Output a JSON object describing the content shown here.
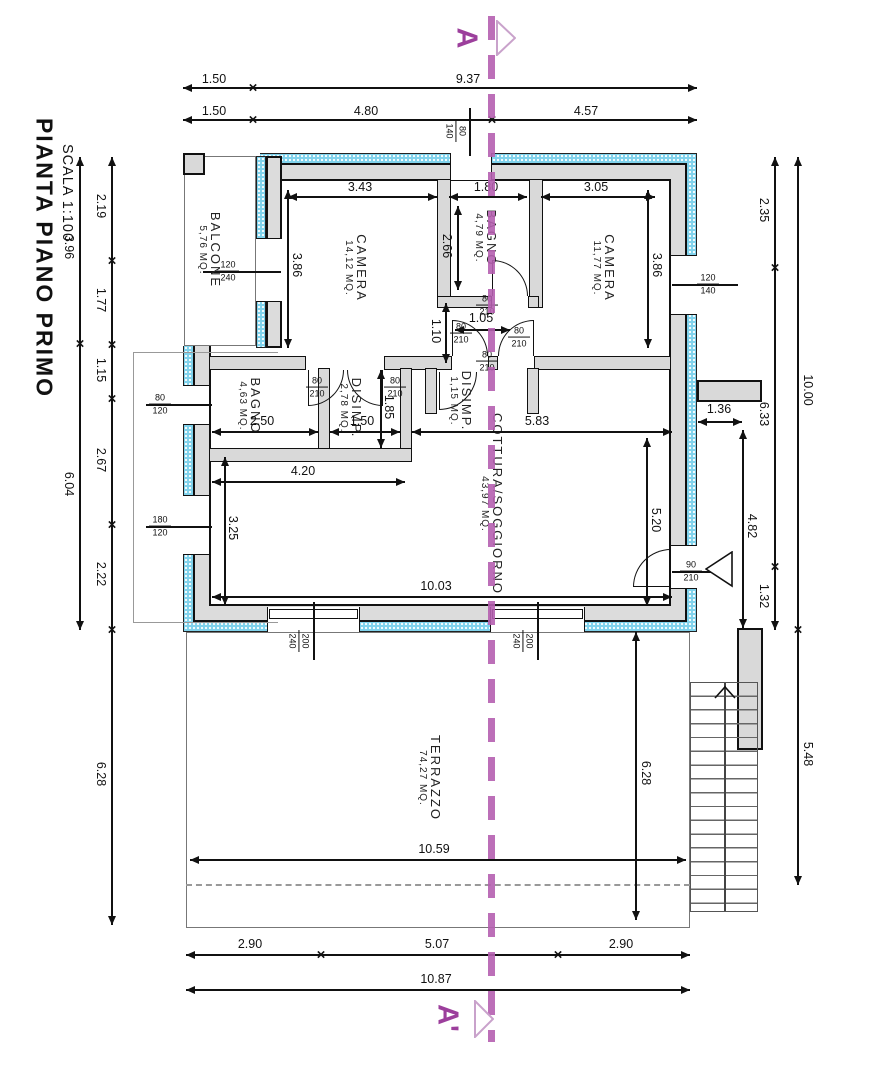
{
  "title": {
    "main": "PIANTA PIANO PRIMO",
    "scale": "SCALA 1:100"
  },
  "section": {
    "top_label": "A",
    "bottom_label": "A'"
  },
  "rooms": [
    {
      "id": "camera1",
      "name": "CAMERA",
      "area": "14,12 MQ."
    },
    {
      "id": "bagno_c",
      "name": "BAGNO",
      "area": "4,79 MQ."
    },
    {
      "id": "camera2",
      "name": "CAMERA",
      "area": "11,77 MQ."
    },
    {
      "id": "bagno_l",
      "name": "BAGNO",
      "area": "4,63 MQ."
    },
    {
      "id": "disimp_a",
      "name": "DISIMP.",
      "area": "2,78 MQ."
    },
    {
      "id": "disimp_b",
      "name": "DISIMP.",
      "area": "1,15 MQ."
    },
    {
      "id": "soggiorno",
      "name": "COTTURA/SOGGIORNO",
      "area": "43,97 MQ."
    },
    {
      "id": "balcone",
      "name": "BALCONE",
      "area": "5,76 MQ."
    },
    {
      "id": "terrazzo",
      "name": "TERRAZZO",
      "area": "74,27 MQ."
    }
  ],
  "dims": {
    "t1a": "1.50",
    "t1b": "9.37",
    "t2a": "1.50",
    "t2b": "4.80",
    "t2c": "4.57",
    "l1": "3.96",
    "l2": "6.04",
    "li1": "2.19",
    "li2": "1.77",
    "li3": "1.15",
    "li4": "2.67",
    "li5": "2.22",
    "li6": "6.28",
    "r1": "4.82",
    "r2": "2.35",
    "r3": "6.33",
    "r4": "1.32",
    "r5": "10.00",
    "r6": "5.48",
    "r7": "1.36",
    "c1": "3.43",
    "c2": "3.86",
    "c3": "1.80",
    "c4": "2.66",
    "c5": "3.05",
    "c6": "3.86",
    "c7": "2.50",
    "c8": "1.50",
    "c9": "1.85",
    "c10": "1.05",
    "c11": "1.10",
    "c12": "5.83",
    "c13": "5.20",
    "c14": "10.03",
    "c15": "4.20",
    "c16": "3.25",
    "tr1": "10.59",
    "tr2": "6.28",
    "b1a": "2.90",
    "b1b": "5.07",
    "b1c": "2.90",
    "b2": "10.87"
  },
  "openings": [
    {
      "id": "o1",
      "top": "80",
      "bottom": "140"
    },
    {
      "id": "o2",
      "top": "120",
      "bottom": "240"
    },
    {
      "id": "o3",
      "top": "120",
      "bottom": "140"
    },
    {
      "id": "o4",
      "top": "80",
      "bottom": "120"
    },
    {
      "id": "o5",
      "top": "180",
      "bottom": "120"
    },
    {
      "id": "o6",
      "top": "200",
      "bottom": "240"
    },
    {
      "id": "o7",
      "top": "200",
      "bottom": "240"
    },
    {
      "id": "o8",
      "top": "80",
      "bottom": "210"
    },
    {
      "id": "o9",
      "top": "80",
      "bottom": "210"
    },
    {
      "id": "o10",
      "top": "80",
      "bottom": "210"
    },
    {
      "id": "o11",
      "top": "80",
      "bottom": "210"
    },
    {
      "id": "o12",
      "top": "80",
      "bottom": "210"
    },
    {
      "id": "o13",
      "top": "80",
      "bottom": "210"
    },
    {
      "id": "o14",
      "top": "90",
      "bottom": "210"
    }
  ],
  "colors": {
    "insulation": "#7fd2ec",
    "wall_fill": "#dcdcdc",
    "partition_fill": "#d9d9d9",
    "section_line": "#b55fb0",
    "section_letter": "#9c3f9c",
    "line": "#111111"
  }
}
